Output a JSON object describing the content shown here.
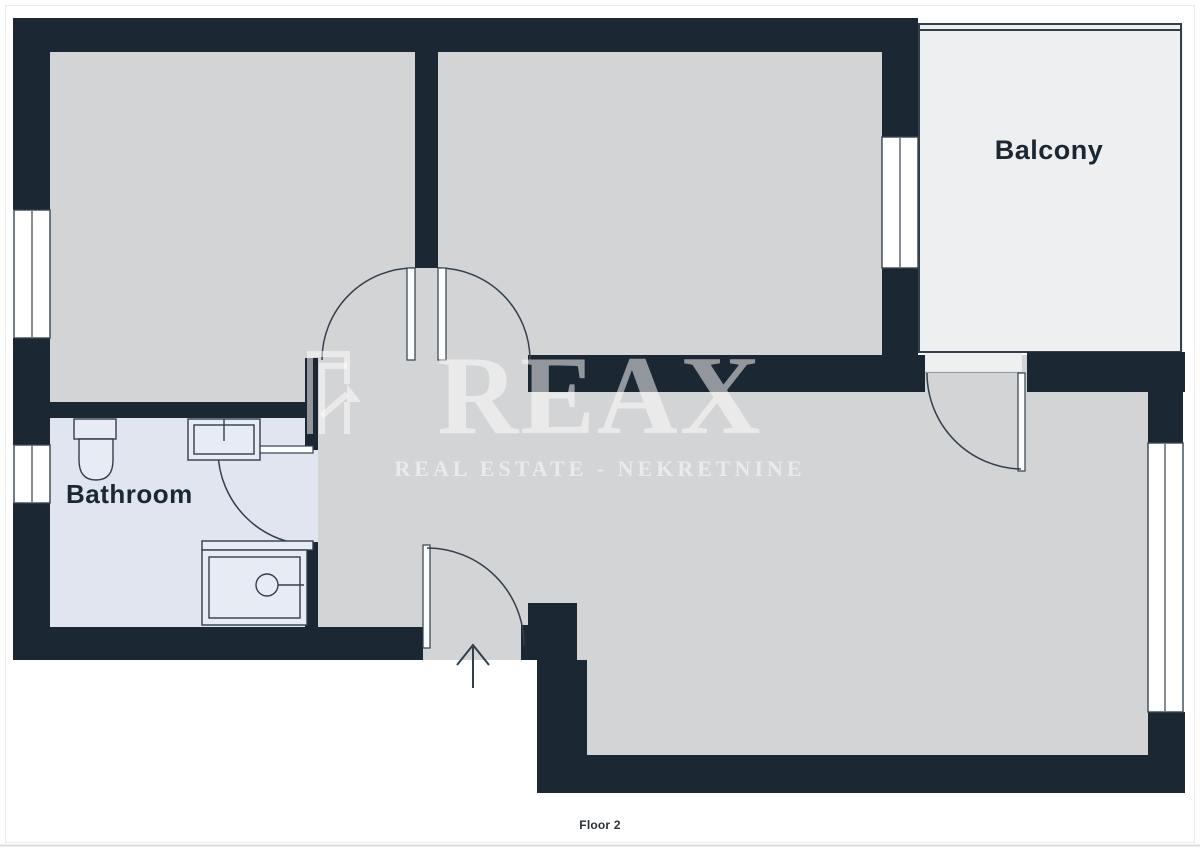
{
  "page": {
    "caption": "Floor 2"
  },
  "rooms": {
    "balcony_label": "Balcony",
    "bathroom_label": "Bathroom"
  },
  "watermark": {
    "brand_left": "RE",
    "brand_right": "AX",
    "tagline": "REAL ESTATE - NEKRETNINE"
  },
  "palette": {
    "wall": "#1b2733",
    "line": "#323f4c",
    "room_floor": "#d3d4d5",
    "balcony_floor": "#edeff1",
    "bathroom_floor": "#e0e5f0",
    "label_text": "#1b2733",
    "watermark_color": "rgba(255,255,255,0.52)"
  }
}
